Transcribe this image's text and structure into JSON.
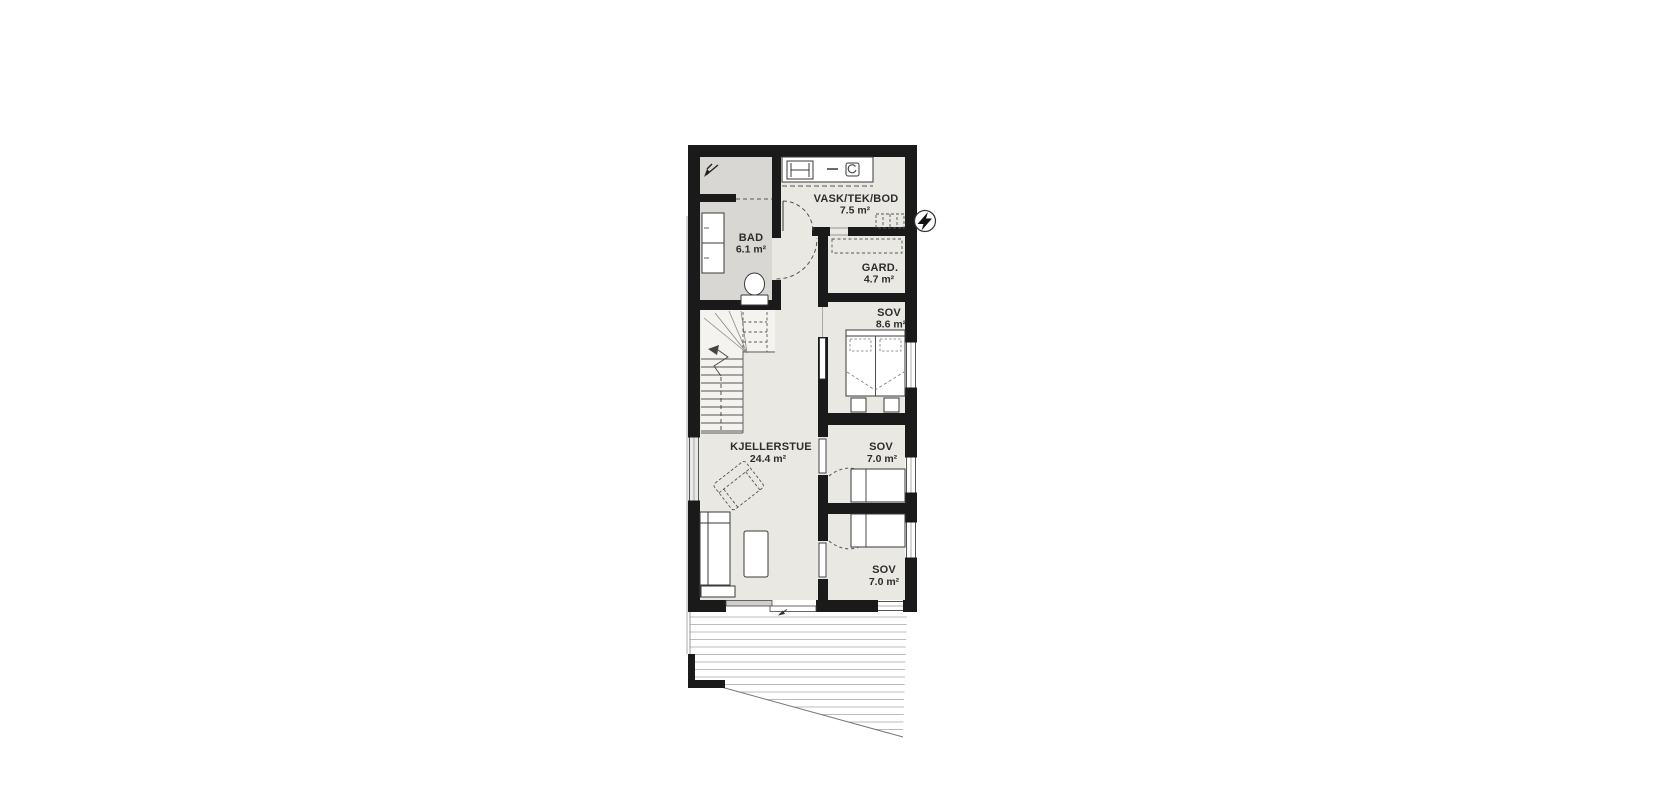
{
  "plan": {
    "type": "floor-plan",
    "floor": "basement",
    "rooms": {
      "bad": {
        "name": "BAD",
        "area": "6.1 m²"
      },
      "vask": {
        "name": "VASK/TEK/BOD",
        "area": "7.5 m²"
      },
      "gard": {
        "name": "GARD.",
        "area": "4.7 m²"
      },
      "sov_main": {
        "name": "SOV",
        "area": "8.6 m²"
      },
      "kjellerstue": {
        "name": "KJELLERSTUE",
        "area": "24.4 m²"
      },
      "sov_mid": {
        "name": "SOV",
        "area": "7.0 m²"
      },
      "sov_bottom": {
        "name": "SOV",
        "area": "7.0 m²"
      }
    },
    "icons": {
      "electric_meter": "lightning-bolt",
      "floor_drain": "drain-slope-arrow"
    },
    "colors": {
      "wall": "#1a1a1a",
      "room_floor": "#eae8e3",
      "bathroom_floor": "#d8d7d4",
      "furniture_line": "#3a3a3a",
      "deck_board_line": "#bcbcbc",
      "dashed_symbol": "#555555"
    }
  }
}
